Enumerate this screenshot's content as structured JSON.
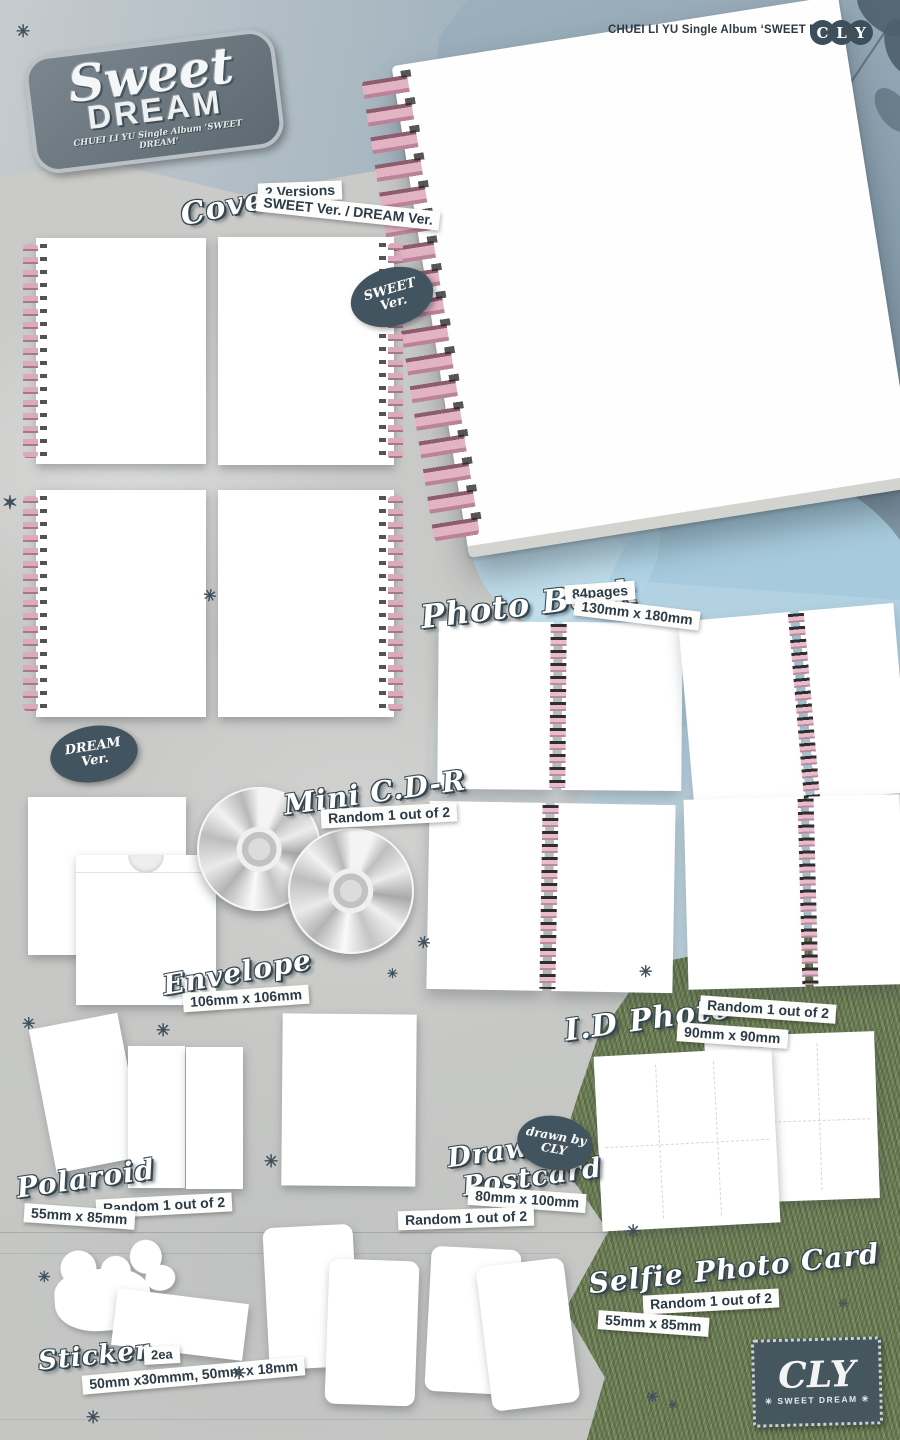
{
  "header": {
    "credit": "CHUEI LI YU Single Album ‘SWEET DREAM’"
  },
  "brand": {
    "name": "CLY",
    "letters": [
      "C",
      "L",
      "Y"
    ]
  },
  "logo": {
    "script": "Sweet",
    "block": "DREAM",
    "credit": "CHUEI LI YU Single Album ‘SWEET DREAM’"
  },
  "badges": {
    "sweet": {
      "line1": "SWEET",
      "line2": "Ver."
    },
    "dream": {
      "line1": "DREAM",
      "line2": "Ver."
    },
    "drawn_by": {
      "line1": "drawn by",
      "line2": "CLY"
    }
  },
  "sections": {
    "cover": {
      "title": "Cover",
      "versions": "2 Versions",
      "versions_detail": "SWEET Ver. / DREAM Ver."
    },
    "photo_book": {
      "title": "Photo Book",
      "pages": "84pages",
      "size": "130mm x 180mm"
    },
    "mini_cdr": {
      "title": "Mini C.D-R",
      "random": "Random 1 out of 2"
    },
    "envelope": {
      "title": "Envelope",
      "size": "106mm x 106mm"
    },
    "id_photo": {
      "title": "I.D Photo",
      "random": "Random 1 out of 2",
      "size": "90mm x 90mm"
    },
    "polaroid": {
      "title": "Polaroid",
      "random": "Random 1 out of 2",
      "size": "55mm x 85mm"
    },
    "drawing_postcard": {
      "title_line1": "Drawing",
      "title_line2": "Postcard",
      "size": "80mm x 100mm",
      "random": "Random 1 out of 2"
    },
    "selfie_photo_card": {
      "title": "Selfie Photo Card",
      "random": "Random 1 out of 2",
      "size": "55mm x 85mm"
    },
    "sticker": {
      "title": "Sticker",
      "count": "2ea",
      "size": "50mm x30mmm, 50mm x 18mm"
    }
  },
  "stamp": {
    "brand": "CLY",
    "subtitle": "✳ SWEET DREAM ✳"
  },
  "decorations": {
    "sparkle": "✳",
    "sparkle6": "✶"
  },
  "colors": {
    "paper": "#c9cac9",
    "slate_dark": "#3e505c",
    "spiral_pink": "#dcaabd",
    "sky_gray_blue": "#92a7b6",
    "watercolor_blue": "#aed4e6",
    "grass_green": "#70815a",
    "white_card": "#ffffff"
  }
}
